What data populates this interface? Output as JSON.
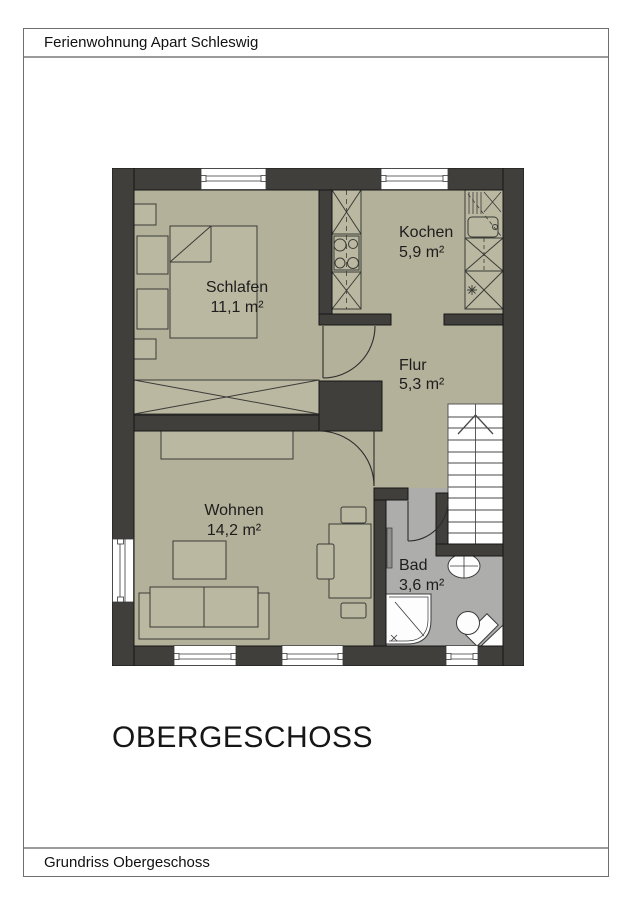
{
  "header": {
    "title": "Ferienwohnung Apart Schleswig"
  },
  "footer": {
    "caption": "Grundriss Obergeschoss"
  },
  "plan": {
    "title": "OBERGESCHOSS"
  },
  "rooms": {
    "schlafen": {
      "name": "Schlafen",
      "area": "11,1 m²"
    },
    "kochen": {
      "name": "Kochen",
      "area": "5,9 m²"
    },
    "flur": {
      "name": "Flur",
      "area": "5,3 m²"
    },
    "wohnen": {
      "name": "Wohnen",
      "area": "14,2 m²"
    },
    "bad": {
      "name": "Bad",
      "area": "3,6 m²"
    }
  },
  "colors": {
    "wall": "#403f3c",
    "floor": "#b3b19a",
    "bad_floor": "#adadab",
    "fixture_white": "#fdfdfd"
  }
}
